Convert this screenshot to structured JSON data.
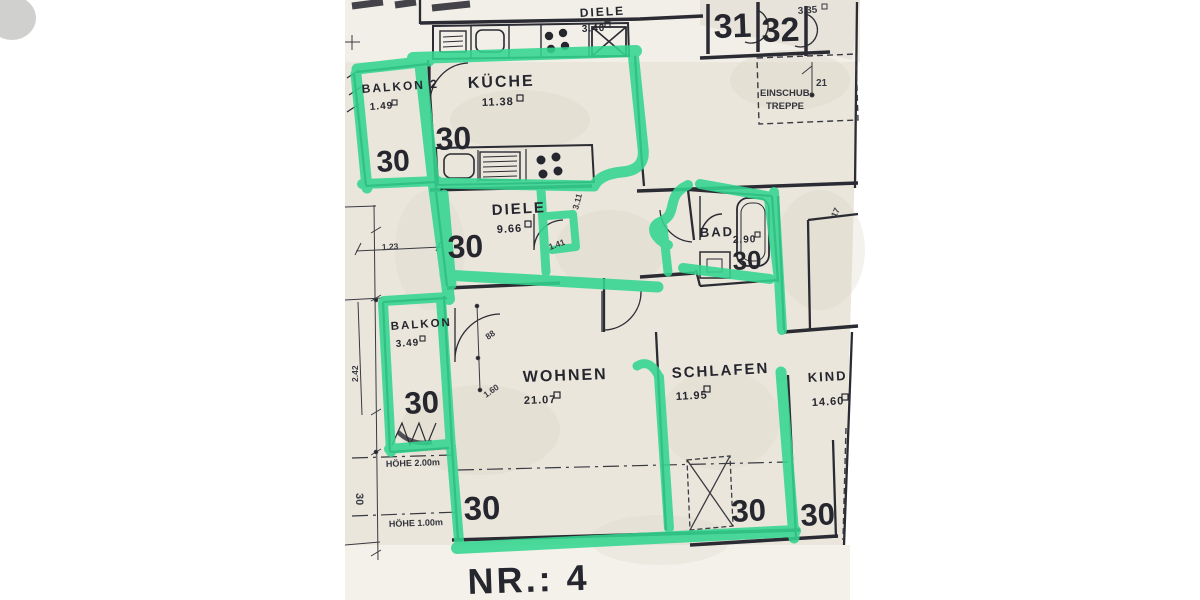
{
  "plan": {
    "title": "NR.: 4",
    "rooms": {
      "kueche": {
        "name": "KÜCHE",
        "area": "11.38"
      },
      "diele": {
        "name": "DIELE",
        "area": "9.66"
      },
      "diele_top": {
        "name": "DIELE",
        "area": "3.40"
      },
      "bad": {
        "name": "BAD",
        "area": "2.90"
      },
      "wohnen": {
        "name": "WOHNEN",
        "area": "21.07"
      },
      "schlafen": {
        "name": "SCHLAFEN",
        "area": "11.95"
      },
      "kind": {
        "name": "KIND",
        "area": "14.60"
      },
      "balkon2": {
        "name": "BALKON 2",
        "area": "1.49"
      },
      "balkon": {
        "name": "BALKON",
        "area": "3.49"
      }
    },
    "units": {
      "thirty": "30",
      "thirty_one": "31",
      "thirty_two": "32"
    },
    "dims": {
      "d123": "1.23",
      "d242": "2.42",
      "d88": "88",
      "d160": "1.60",
      "d311": "3.11",
      "d141": "1.41",
      "d17": "17",
      "d21": "21",
      "d335": "3.35"
    },
    "notes": {
      "hoehe2": "HÖHE 2.00m",
      "hoehe1": "HÖHE 1.00m",
      "einschub1": "EINSCHUB-",
      "einschub2": "TREPPE"
    },
    "colors": {
      "highlighter": "#33d690",
      "paper": "#eae6dc",
      "ink": "#26262e"
    }
  }
}
